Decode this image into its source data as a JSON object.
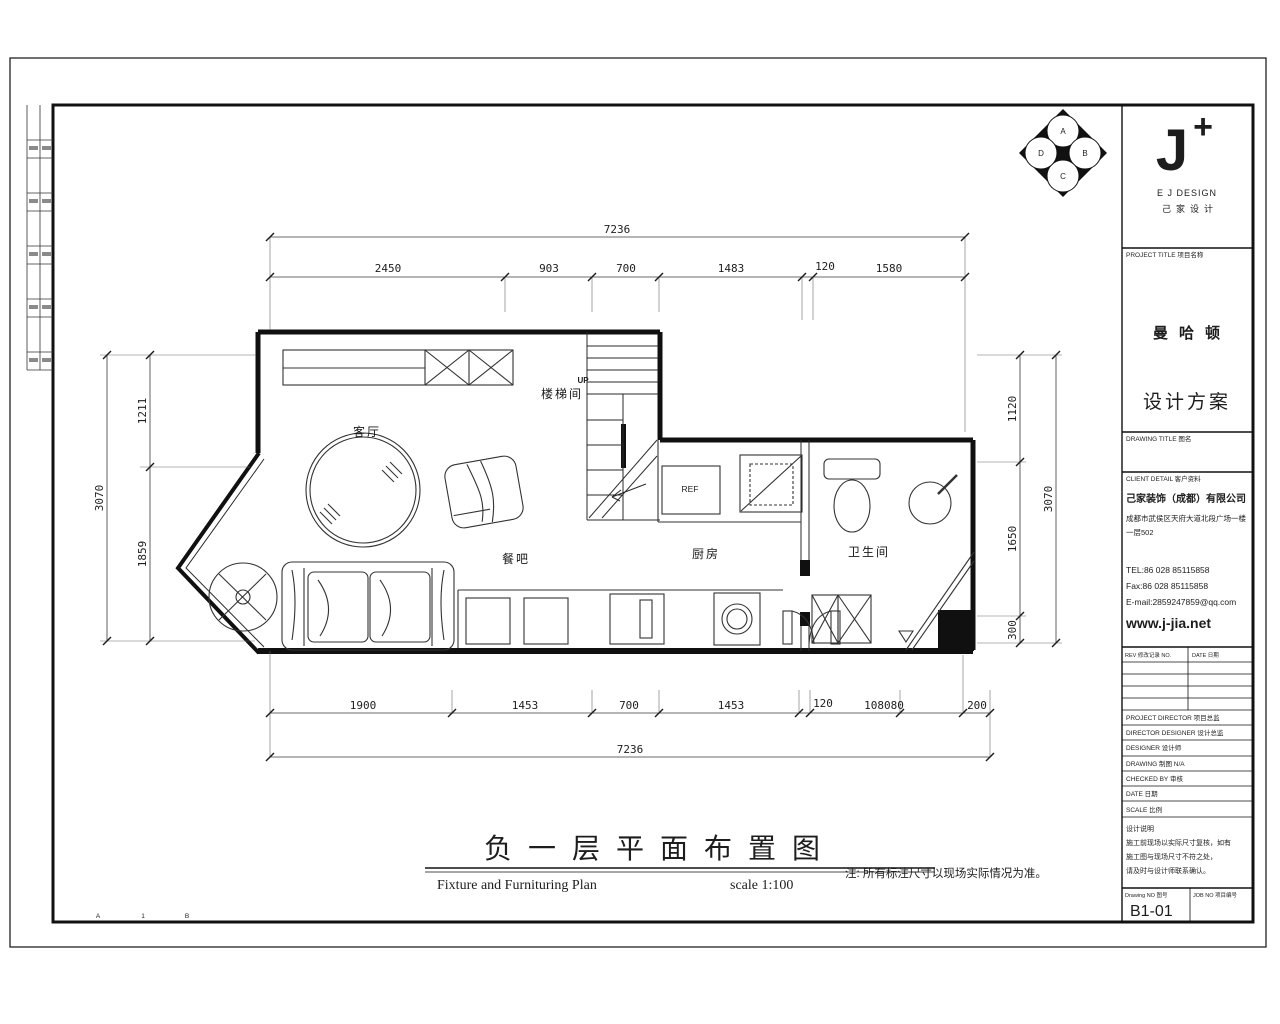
{
  "dims": {
    "top_overall": "7236",
    "top_segments": [
      "2450",
      "903",
      "700",
      "1483",
      "120",
      "1580"
    ],
    "bottom_segments": [
      "1900",
      "1453",
      "700",
      "1453",
      "120",
      "108080",
      "200"
    ],
    "bottom_overall": "7236",
    "left_overall": "3070",
    "left_segments": [
      "1211",
      "1859"
    ],
    "right_segments": [
      "1120",
      "1650",
      "300"
    ],
    "right_overall": "3070"
  },
  "plan": {
    "rooms": {
      "living": "客厅",
      "stair": "楼梯间",
      "bar": "餐吧",
      "kitchen": "厨房",
      "bath": "卫生间"
    },
    "labels": {
      "up": "UP",
      "ref": "REF"
    }
  },
  "stamp": {
    "letters": [
      "A",
      "B",
      "C",
      "D"
    ]
  },
  "grid_refs": [
    "A",
    "1",
    "B"
  ],
  "footer": {
    "title_cn": "负一层平面布置图",
    "title_en": "Fixture and Furnituring Plan",
    "scale": "scale 1:100",
    "note": "注: 所有标注尺寸以现场实际情况为准。"
  },
  "title_block": {
    "logo_j": "J",
    "logo_plus": "+",
    "logo_en": "E J DESIGN",
    "logo_cn": "己家设计",
    "project_header": "PROJECT TITLE 项目名称",
    "project_name": "曼哈顿",
    "project_type": "设计方案",
    "project_name_color": "#dede2e",
    "drawing_header": "DRAWING TITLE 图名",
    "client_header": "CLIENT DETAIL 客户资料",
    "company": "己家装饰（成都）有限公司",
    "address1": "成都市武侯区天府大道北段广场一楼",
    "address2": "一层502",
    "tel": "TEL:86 028 85115858",
    "fax": "Fax:86 028 85115858",
    "email": "E-mail:2859247859@qq.com",
    "website": "www.j-jia.net",
    "rev_header": "REV 修改记录 NO.",
    "date_header": "DATE 日期",
    "fields": [
      "PROJECT DIRECTOR 项目总监",
      "DIRECTOR DESIGNER 设计总监",
      "DESIGNER 设计师",
      "DRAWING 制图 N/A",
      "CHECKED BY 审核",
      "DATE 日期",
      "SCALE 比例"
    ],
    "notes": [
      "设计说明",
      "施工前现场以实际尺寸复核，如有",
      "施工图与现场尺寸不符之处，",
      "请及时与设计师联系确认。"
    ],
    "drawing_no_label": "Drawing NO 图号",
    "drawing_no": "B1-01",
    "job_no_label": "JOB NO 项目编号"
  }
}
